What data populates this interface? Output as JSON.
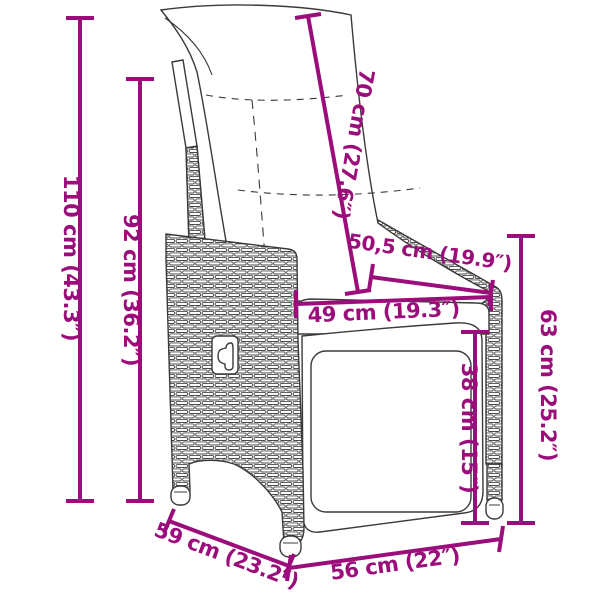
{
  "diagram": {
    "subject": "reclining garden chair with cushions - dimension diagram",
    "background_color": "#ffffff",
    "accent_color": "#9b0d7a",
    "line_art_color": "#3a3a3a",
    "dimensions": [
      {
        "name": "total-height",
        "label": "110 cm (43.3″)",
        "orientation": "vertical"
      },
      {
        "name": "back-height",
        "label": "92 cm (36.2″)",
        "orientation": "vertical"
      },
      {
        "name": "backrest-length",
        "label": "70 cm (27.6″)",
        "orientation": "diagonal"
      },
      {
        "name": "armrest-length",
        "label": "50,5 cm (19.9″)",
        "orientation": "diagonal"
      },
      {
        "name": "seat-depth-top",
        "label": "49 cm (19.3″)",
        "orientation": "horizontal"
      },
      {
        "name": "armrest-height",
        "label": "63 cm (25.2″)",
        "orientation": "vertical"
      },
      {
        "name": "seat-height",
        "label": "38 cm (15″)",
        "orientation": "vertical"
      },
      {
        "name": "base-depth",
        "label": "59 cm (23.2″)",
        "orientation": "diagonal"
      },
      {
        "name": "base-width",
        "label": "56 cm (22″)",
        "orientation": "horizontal"
      }
    ]
  }
}
